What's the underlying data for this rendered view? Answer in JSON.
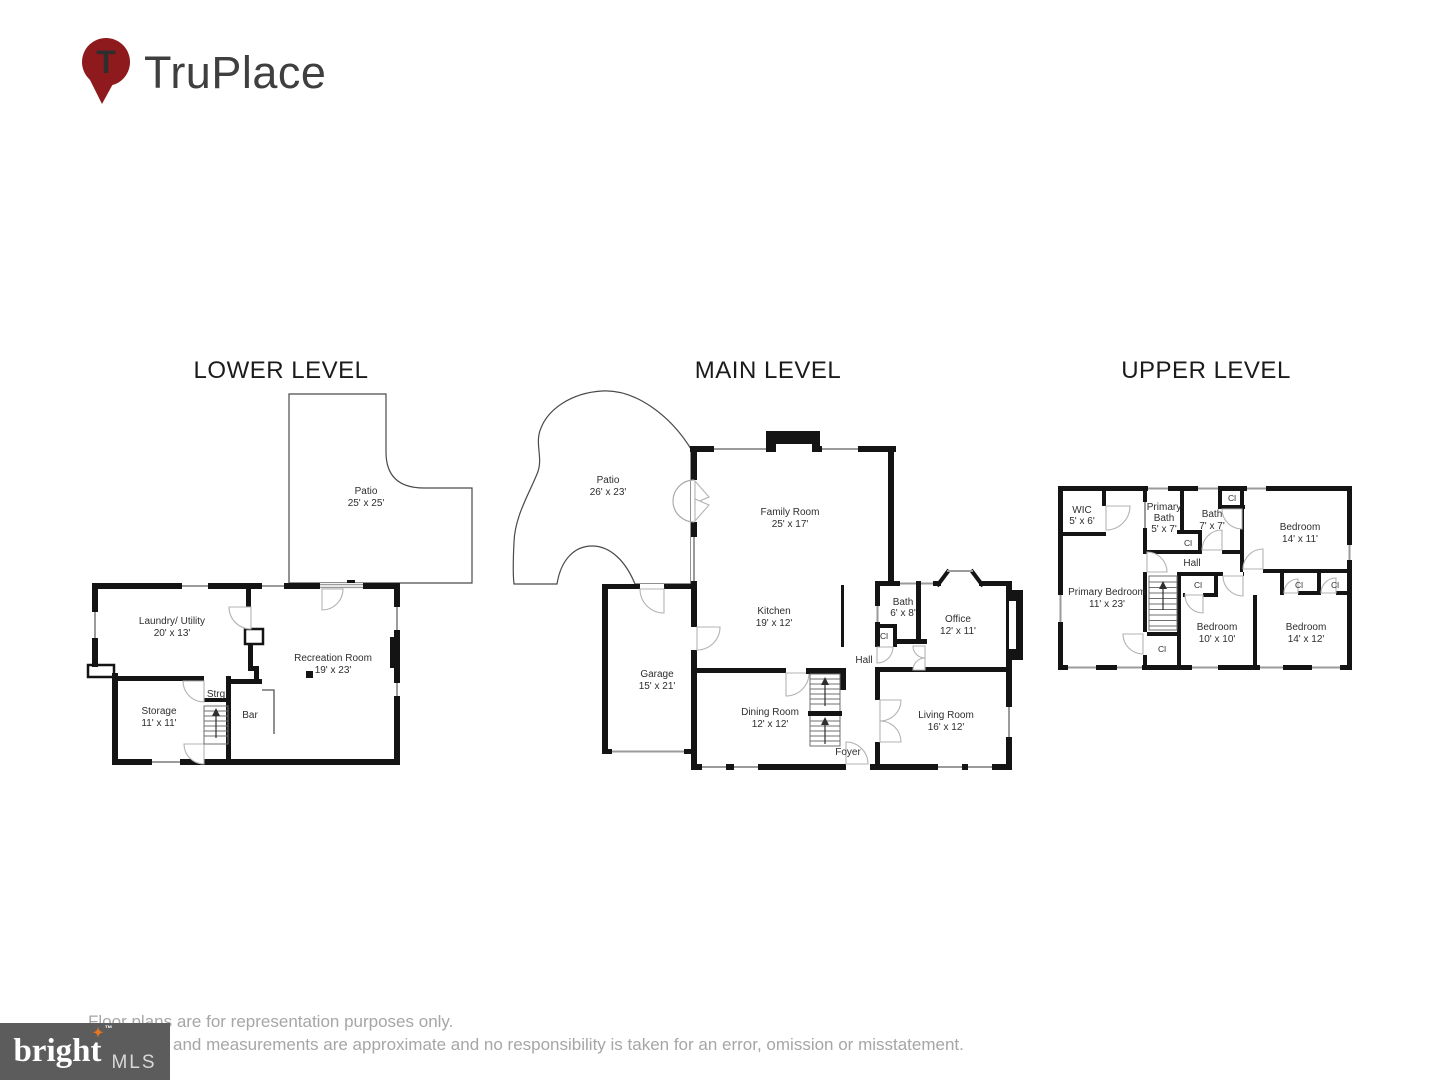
{
  "brand": {
    "name": "TruPlace",
    "pin_letter": "T"
  },
  "levels": {
    "lower": {
      "title": "LOWER LEVEL",
      "rooms": {
        "patio": {
          "name": "Patio",
          "dims": "25' x 25'"
        },
        "laundry_utility": {
          "name": "Laundry/ Utility",
          "dims": "20' x 13'"
        },
        "recreation_room": {
          "name": "Recreation Room",
          "dims": "19' x 23'"
        },
        "storage": {
          "name": "Storage",
          "dims": "11' x 11'"
        },
        "strg": {
          "name": "Strg"
        },
        "bar": {
          "name": "Bar"
        }
      }
    },
    "main": {
      "title": "MAIN LEVEL",
      "rooms": {
        "patio": {
          "name": "Patio",
          "dims": "26' x 23'"
        },
        "family_room": {
          "name": "Family Room",
          "dims": "25' x 17'"
        },
        "kitchen": {
          "name": "Kitchen",
          "dims": "19' x 12'"
        },
        "garage": {
          "name": "Garage",
          "dims": "15' x 21'"
        },
        "dining_room": {
          "name": "Dining Room",
          "dims": "12' x 12'"
        },
        "bath": {
          "name": "Bath",
          "dims": "6' x 8'"
        },
        "closet": {
          "name": "Cl"
        },
        "office": {
          "name": "Office",
          "dims": "12' x 11'"
        },
        "hall": {
          "name": "Hall"
        },
        "living_room": {
          "name": "Living Room",
          "dims": "16' x 12'"
        },
        "foyer": {
          "name": "Foyer"
        }
      }
    },
    "upper": {
      "title": "UPPER LEVEL",
      "rooms": {
        "wic": {
          "name": "WIC",
          "dims": "5' x 6'"
        },
        "primary_bath": {
          "name_line1": "Primary",
          "name_line2": "Bath",
          "dims": "5' x 7'"
        },
        "bath": {
          "name": "Bath",
          "dims": "7' x 7'"
        },
        "closet_bath": {
          "name": "Cl"
        },
        "bedroom_right": {
          "name": "Bedroom",
          "dims": "14' x 11'"
        },
        "primary_bedroom": {
          "name": "Primary Bedroom",
          "dims": "11' x 23'"
        },
        "hall": {
          "name": "Hall"
        },
        "closet_mid": {
          "name": "Cl"
        },
        "closet_stairs": {
          "name": "Cl"
        },
        "closet_bedroom_middle": {
          "name": "Cl"
        },
        "closet_br_1": {
          "name": "Cl"
        },
        "closet_br_2": {
          "name": "Cl"
        },
        "bedroom_middle": {
          "name": "Bedroom",
          "dims": "10' x 10'"
        },
        "bedroom_bottom_right": {
          "name": "Bedroom",
          "dims": "14' x 12'"
        }
      }
    }
  },
  "footer": {
    "disclaimer_line1": "Floor plans are for representation purposes only.",
    "disclaimer_line2": "and measurements are approximate and no responsibility is taken for an error, omission or misstatement.",
    "mls": {
      "brand": "bright",
      "suffix": "MLS",
      "tm": "™",
      "star": "✦"
    }
  },
  "colors": {
    "wall": "#141414",
    "window_line": "#9b9b9b",
    "door_arc": "#b3b3b3",
    "brand_red": "#8e1a1d",
    "mls_bg": "#5c5c5c",
    "mls_orange": "#e87722",
    "label_text": "#2e2e2e",
    "disclaimer_text": "#a6a6a6"
  }
}
